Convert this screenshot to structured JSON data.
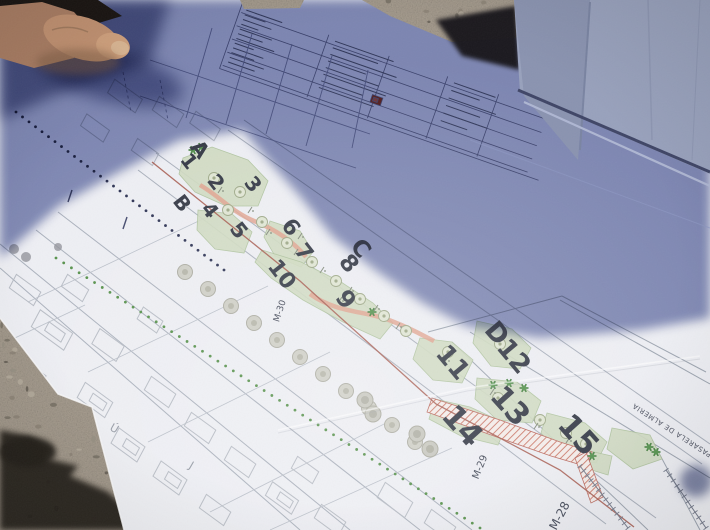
{
  "plan": {
    "zone_labels": [
      {
        "text": "A",
        "x": 199,
        "y": 150,
        "r": 52,
        "s": 21
      },
      {
        "text": "1",
        "x": 188,
        "y": 162,
        "r": 52,
        "s": 20
      },
      {
        "text": "2",
        "x": 215,
        "y": 183,
        "r": 52,
        "s": 20
      },
      {
        "text": "3",
        "x": 252,
        "y": 185,
        "r": 52,
        "s": 20
      },
      {
        "text": "B",
        "x": 181,
        "y": 204,
        "r": 52,
        "s": 20
      },
      {
        "text": "4",
        "x": 209,
        "y": 211,
        "r": 52,
        "s": 20
      },
      {
        "text": "5",
        "x": 238,
        "y": 231,
        "r": 52,
        "s": 21
      },
      {
        "text": "6",
        "x": 290,
        "y": 228,
        "r": 52,
        "s": 22
      },
      {
        "text": "7",
        "x": 303,
        "y": 253,
        "r": 52,
        "s": 22
      },
      {
        "text": "C",
        "x": 360,
        "y": 249,
        "r": 52,
        "s": 23
      },
      {
        "text": "8",
        "x": 348,
        "y": 264,
        "r": 52,
        "s": 23
      },
      {
        "text": "10",
        "x": 281,
        "y": 275,
        "r": 52,
        "s": 22
      },
      {
        "text": "9",
        "x": 345,
        "y": 300,
        "r": 52,
        "s": 24
      },
      {
        "text": "D",
        "x": 496,
        "y": 334,
        "r": 50,
        "s": 26
      },
      {
        "text": "11",
        "x": 452,
        "y": 363,
        "r": 50,
        "s": 26
      },
      {
        "text": "12",
        "x": 513,
        "y": 357,
        "r": 50,
        "s": 26
      },
      {
        "text": "13",
        "x": 509,
        "y": 407,
        "r": 48,
        "s": 30
      },
      {
        "text": "14",
        "x": 461,
        "y": 427,
        "r": 48,
        "s": 31
      },
      {
        "text": "15",
        "x": 577,
        "y": 436,
        "r": 48,
        "s": 31
      }
    ],
    "street_labels": [
      {
        "text": "M-30",
        "x": 280,
        "y": 311,
        "r": -72,
        "s": 9
      },
      {
        "text": "M-29",
        "x": 480,
        "y": 467,
        "r": -68,
        "s": 10
      },
      {
        "text": "M-28",
        "x": 560,
        "y": 516,
        "r": -62,
        "s": 12
      }
    ],
    "area_label": {
      "text": "PASARELA DE ALMERIA",
      "x": 672,
      "y": 430,
      "r": -147,
      "s": 7
    },
    "parcel_letters": [
      {
        "text": "J",
        "x": 191,
        "y": 466,
        "r": 30,
        "s": 11
      },
      {
        "text": "Ú",
        "x": 114,
        "y": 429,
        "r": 30,
        "s": 11
      }
    ]
  },
  "palette": {
    "paper": "#edeef3",
    "paper_shadow": "#7e88b6",
    "gravel": "#a89e90",
    "fabric": "#98a1bc",
    "fabric_dark": "#8a93b0",
    "skin": "#c09070",
    "zone_green": "#cfdabf",
    "tree_green": "#3f7d3a",
    "path_salmon": "#dfa08c",
    "hatch_red": "#c8705f",
    "road_red": "#a4574a",
    "dotted_green": "#4e8c42",
    "line_gray": "#a6adb9",
    "ink": "#2e3340"
  }
}
